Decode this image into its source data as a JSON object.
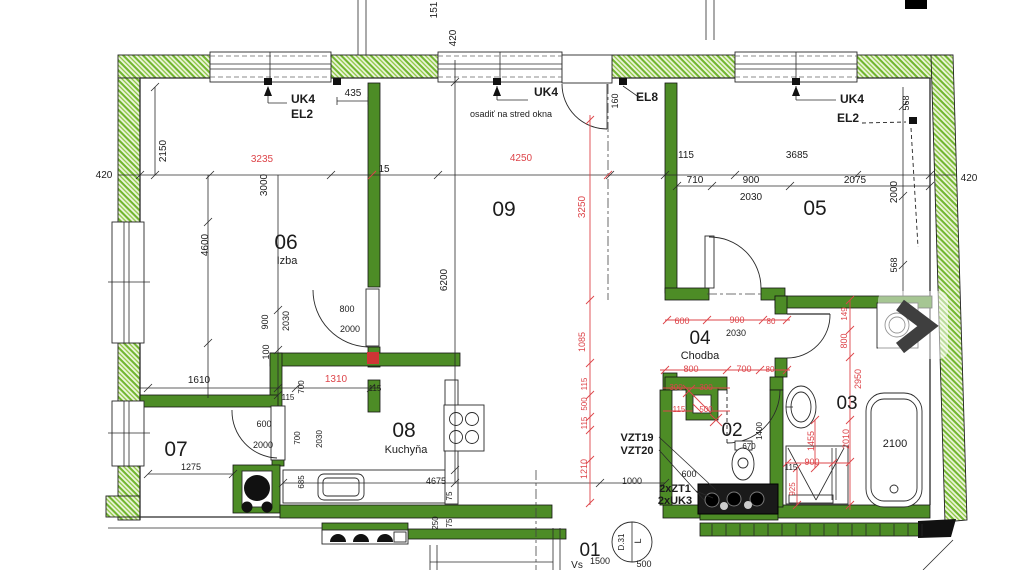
{
  "colors": {
    "wall_green": "#4d8c26",
    "hatch_green": "#71b52f",
    "hatch_bg": "#edf6de",
    "dim_red": "#dd4449",
    "line_dark": "#1c1c1c",
    "overlay_arrow": "#3f3f3f"
  },
  "overlay": {
    "next_icon": "chevron-right"
  },
  "rooms": [
    {
      "number": "01"
    },
    {
      "number": "02"
    },
    {
      "number": "03"
    },
    {
      "number": "04",
      "name": "Chodba"
    },
    {
      "number": "05"
    },
    {
      "number": "06",
      "name": "Izba"
    },
    {
      "number": "07"
    },
    {
      "number": "08",
      "name": "Kuchyňa"
    },
    {
      "number": "09"
    }
  ],
  "labels": [
    {
      "t": "151",
      "x": 437,
      "y": 10,
      "r": 1,
      "n": "dim-151"
    },
    {
      "t": "420",
      "x": 456,
      "y": 38,
      "r": 1,
      "n": "dim-420-top"
    },
    {
      "t": "UK4",
      "x": 303,
      "y": 103,
      "b": 1,
      "s": 12,
      "n": "annotation-uk4-left"
    },
    {
      "t": "EL2",
      "x": 302,
      "y": 118,
      "b": 1,
      "s": 12,
      "n": "annotation-el2-left"
    },
    {
      "t": "435",
      "x": 353,
      "y": 96,
      "n": "dim-435"
    },
    {
      "t": "UK4",
      "x": 546,
      "y": 96,
      "b": 1,
      "s": 12,
      "n": "annotation-uk4-mid"
    },
    {
      "t": "osadiť na stred okna",
      "x": 511,
      "y": 117,
      "s": 9,
      "n": "annotation-note"
    },
    {
      "t": "160",
      "x": 618,
      "y": 101,
      "r": 1,
      "s": 9,
      "n": "dim-160"
    },
    {
      "t": "EL8",
      "x": 647,
      "y": 101,
      "b": 1,
      "s": 12,
      "n": "annotation-el8"
    },
    {
      "t": "UK4",
      "x": 852,
      "y": 103,
      "b": 1,
      "s": 12,
      "n": "annotation-uk4-right"
    },
    {
      "t": "EL2",
      "x": 848,
      "y": 122,
      "b": 1,
      "s": 12,
      "n": "annotation-el2-right"
    },
    {
      "t": "568",
      "x": 909,
      "y": 103,
      "r": 1,
      "s": 9,
      "n": "dim-568-top"
    },
    {
      "t": "420",
      "x": 104,
      "y": 178,
      "n": "dim-420-left"
    },
    {
      "t": "2150",
      "x": 166,
      "y": 151,
      "r": 1,
      "n": "dim-2150"
    },
    {
      "t": "3235",
      "x": 262,
      "y": 162,
      "c": "r",
      "n": "dim-3235"
    },
    {
      "t": "3000",
      "x": 267,
      "y": 185,
      "r": 1,
      "n": "dim-3000"
    },
    {
      "t": "15",
      "x": 384,
      "y": 172,
      "n": "dim-15"
    },
    {
      "t": "4250",
      "x": 521,
      "y": 161,
      "c": "r",
      "n": "dim-4250"
    },
    {
      "t": "115",
      "x": 686,
      "y": 158,
      "n": "dim-115-a"
    },
    {
      "t": "3685",
      "x": 797,
      "y": 158,
      "n": "dim-3685"
    },
    {
      "t": "420",
      "x": 969,
      "y": 181,
      "n": "dim-420-right"
    },
    {
      "t": "710",
      "x": 695,
      "y": 183,
      "n": "dim-710"
    },
    {
      "t": "900",
      "x": 751,
      "y": 183,
      "n": "dim-900-05"
    },
    {
      "t": "2075",
      "x": 855,
      "y": 183,
      "n": "dim-2075"
    },
    {
      "t": "2030",
      "x": 751,
      "y": 200,
      "n": "dim-2030-05"
    },
    {
      "t": "2000",
      "x": 897,
      "y": 192,
      "r": 1,
      "n": "dim-2000-right"
    },
    {
      "t": "568",
      "x": 897,
      "y": 265,
      "r": 1,
      "s": 9,
      "n": "dim-568-low"
    },
    {
      "t": "05",
      "x": 815,
      "y": 215,
      "s": 21,
      "n": "room-number-05"
    },
    {
      "t": "09",
      "x": 504,
      "y": 216,
      "s": 21,
      "n": "room-number-09"
    },
    {
      "t": "06",
      "x": 286,
      "y": 249,
      "s": 21,
      "n": "room-number-06"
    },
    {
      "t": "Izba",
      "x": 287,
      "y": 264,
      "s": 11,
      "n": "room-name-izba"
    },
    {
      "t": "4600",
      "x": 208,
      "y": 245,
      "r": 1,
      "n": "dim-4600"
    },
    {
      "t": "3250",
      "x": 585,
      "y": 207,
      "r": 1,
      "c": "r",
      "n": "dim-3250"
    },
    {
      "t": "6200",
      "x": 447,
      "y": 280,
      "r": 1,
      "n": "dim-6200"
    },
    {
      "t": "900",
      "x": 268,
      "y": 322,
      "r": 1,
      "s": 9,
      "n": "dim-900-06"
    },
    {
      "t": "2030",
      "x": 289,
      "y": 321,
      "r": 1,
      "s": 9,
      "n": "dim-2030-06"
    },
    {
      "t": "800",
      "x": 347,
      "y": 312,
      "s": 9,
      "n": "dim-800-door06"
    },
    {
      "t": "2000",
      "x": 350,
      "y": 332,
      "s": 9,
      "n": "dim-2000-door06"
    },
    {
      "t": "100",
      "x": 269,
      "y": 352,
      "r": 1,
      "s": 9,
      "n": "dim-100"
    },
    {
      "t": "1085",
      "x": 585,
      "y": 342,
      "r": 1,
      "c": "r",
      "s": 9,
      "n": "dim-1085"
    },
    {
      "t": "1610",
      "x": 199,
      "y": 383,
      "n": "dim-1610"
    },
    {
      "t": "1310",
      "x": 336,
      "y": 382,
      "c": "r",
      "n": "dim-1310"
    },
    {
      "t": "115",
      "x": 288,
      "y": 400,
      "s": 8,
      "n": "dim-115-b"
    },
    {
      "t": "700",
      "x": 304,
      "y": 387,
      "r": 1,
      "s": 8,
      "n": "dim-700-a"
    },
    {
      "t": "115",
      "x": 375,
      "y": 391,
      "s": 8,
      "n": "dim-115-c"
    },
    {
      "t": "07",
      "x": 176,
      "y": 456,
      "s": 21,
      "n": "room-number-07"
    },
    {
      "t": "1275",
      "x": 191,
      "y": 470,
      "s": 9,
      "n": "dim-1275"
    },
    {
      "t": "600",
      "x": 264,
      "y": 427,
      "s": 9,
      "n": "dim-600-door07"
    },
    {
      "t": "2000",
      "x": 263,
      "y": 448,
      "s": 9,
      "n": "dim-2000-door07"
    },
    {
      "t": "700",
      "x": 300,
      "y": 438,
      "r": 1,
      "s": 8,
      "n": "dim-700-b"
    },
    {
      "t": "2030",
      "x": 322,
      "y": 439,
      "r": 1,
      "s": 8,
      "n": "dim-2030-07"
    },
    {
      "t": "685",
      "x": 304,
      "y": 482,
      "r": 1,
      "s": 8,
      "n": "dim-685"
    },
    {
      "t": "08",
      "x": 404,
      "y": 437,
      "s": 21,
      "n": "room-number-08"
    },
    {
      "t": "Kuchyňa",
      "x": 406,
      "y": 453,
      "s": 11,
      "n": "room-name-kuchyna"
    },
    {
      "t": "4675",
      "x": 436,
      "y": 484,
      "s": 9,
      "n": "dim-4675"
    },
    {
      "t": "75",
      "x": 452,
      "y": 496,
      "r": 1,
      "s": 8,
      "n": "dim-75-a"
    },
    {
      "t": "250",
      "x": 438,
      "y": 523,
      "r": 1,
      "s": 8,
      "n": "dim-250"
    },
    {
      "t": "75",
      "x": 452,
      "y": 523,
      "r": 1,
      "s": 8,
      "n": "dim-75-b"
    },
    {
      "t": "115",
      "x": 587,
      "y": 384,
      "r": 1,
      "c": "r",
      "s": 8,
      "n": "dim-115-red-a"
    },
    {
      "t": "500",
      "x": 587,
      "y": 404,
      "r": 1,
      "c": "r",
      "s": 8,
      "n": "dim-500-red-a"
    },
    {
      "t": "115",
      "x": 587,
      "y": 423,
      "r": 1,
      "c": "r",
      "s": 8,
      "n": "dim-115-red-b"
    },
    {
      "t": "1210",
      "x": 587,
      "y": 469,
      "r": 1,
      "c": "r",
      "s": 9,
      "n": "dim-1210"
    },
    {
      "t": "1000",
      "x": 632,
      "y": 484,
      "s": 9,
      "n": "dim-1000"
    },
    {
      "t": "04",
      "x": 700,
      "y": 344,
      "s": 19,
      "n": "room-number-04"
    },
    {
      "t": "Chodba",
      "x": 700,
      "y": 359,
      "s": 11,
      "n": "room-name-chodba"
    },
    {
      "t": "600",
      "x": 682,
      "y": 324,
      "c": "r",
      "s": 9,
      "n": "dim-600-red"
    },
    {
      "t": "900",
      "x": 737,
      "y": 323,
      "c": "r",
      "s": 9,
      "n": "dim-900-red"
    },
    {
      "t": "80",
      "x": 771,
      "y": 324,
      "c": "r",
      "s": 8,
      "n": "dim-80-a"
    },
    {
      "t": "2030",
      "x": 736,
      "y": 336,
      "s": 9,
      "n": "dim-2030-04"
    },
    {
      "t": "800",
      "x": 691,
      "y": 372,
      "c": "r",
      "s": 9,
      "n": "dim-800-red"
    },
    {
      "t": "700",
      "x": 744,
      "y": 372,
      "c": "r",
      "s": 9,
      "n": "dim-700-red"
    },
    {
      "t": "80",
      "x": 770,
      "y": 372,
      "c": "r",
      "s": 8,
      "n": "dim-80-b"
    },
    {
      "t": "300",
      "x": 676,
      "y": 390,
      "c": "r",
      "s": 8,
      "n": "dim-300-a"
    },
    {
      "t": "300",
      "x": 706,
      "y": 390,
      "c": "r",
      "s": 8,
      "n": "dim-300-b"
    },
    {
      "t": "115",
      "x": 679,
      "y": 412,
      "c": "r",
      "s": 8,
      "n": "dim-115-red-c"
    },
    {
      "t": "500",
      "x": 706,
      "y": 412,
      "c": "r",
      "s": 8,
      "n": "dim-500-red-b"
    },
    {
      "t": "02",
      "x": 732,
      "y": 436,
      "s": 19,
      "n": "room-number-02"
    },
    {
      "t": "670",
      "x": 749,
      "y": 449,
      "s": 8,
      "n": "dim-670"
    },
    {
      "t": "1400",
      "x": 762,
      "y": 431,
      "r": 1,
      "s": 8,
      "n": "dim-1400"
    },
    {
      "t": "VZT19",
      "x": 637,
      "y": 441,
      "b": 1,
      "s": 11,
      "n": "annotation-vzt19"
    },
    {
      "t": "VZT20",
      "x": 637,
      "y": 454,
      "b": 1,
      "s": 11,
      "n": "annotation-vzt20"
    },
    {
      "t": "600",
      "x": 689,
      "y": 477,
      "s": 9,
      "n": "dim-600-b"
    },
    {
      "t": "2xZT1",
      "x": 675,
      "y": 492,
      "b": 1,
      "s": 11,
      "n": "annotation-2xzt1"
    },
    {
      "t": "2xUK3",
      "x": 675,
      "y": 504,
      "b": 1,
      "s": 11,
      "n": "annotation-2xuk3"
    },
    {
      "t": "03",
      "x": 847,
      "y": 409,
      "s": 19,
      "n": "room-number-03"
    },
    {
      "t": "149",
      "x": 847,
      "y": 314,
      "r": 1,
      "c": "r",
      "s": 8,
      "n": "dim-149"
    },
    {
      "t": "800",
      "x": 847,
      "y": 341,
      "r": 1,
      "c": "r",
      "s": 9,
      "n": "dim-800-red-v"
    },
    {
      "t": "2950",
      "x": 861,
      "y": 379,
      "r": 1,
      "c": "r",
      "s": 9,
      "n": "dim-2950"
    },
    {
      "t": "1455",
      "x": 814,
      "y": 441,
      "r": 1,
      "c": "r",
      "s": 9,
      "n": "dim-1455"
    },
    {
      "t": "2010",
      "x": 849,
      "y": 439,
      "r": 1,
      "c": "r",
      "s": 9,
      "n": "dim-2010"
    },
    {
      "t": "115",
      "x": 791,
      "y": 470,
      "s": 8,
      "n": "dim-115-d"
    },
    {
      "t": "900",
      "x": 812,
      "y": 465,
      "c": "r",
      "s": 9,
      "n": "dim-900-shower"
    },
    {
      "t": "925",
      "x": 795,
      "y": 489,
      "r": 1,
      "c": "r",
      "s": 8,
      "n": "dim-925"
    },
    {
      "t": "2100",
      "x": 895,
      "y": 447,
      "s": 11,
      "n": "dim-2100-tub"
    },
    {
      "t": "01",
      "x": 590,
      "y": 556,
      "s": 19,
      "n": "room-number-01"
    },
    {
      "t": "Vs",
      "x": 577,
      "y": 568,
      "s": 10,
      "n": "room-name-01-partial"
    },
    {
      "t": "1500",
      "x": 600,
      "y": 564,
      "s": 9,
      "n": "dim-1500"
    },
    {
      "t": "500",
      "x": 644,
      "y": 567,
      "s": 9,
      "n": "dim-500-b"
    },
    {
      "t": "D.31",
      "x": 624,
      "y": 542,
      "r": 1,
      "s": 8,
      "n": "door-tag-d31"
    },
    {
      "t": "L",
      "x": 641,
      "y": 541,
      "r": 1,
      "s": 9,
      "n": "door-tag-l"
    }
  ]
}
